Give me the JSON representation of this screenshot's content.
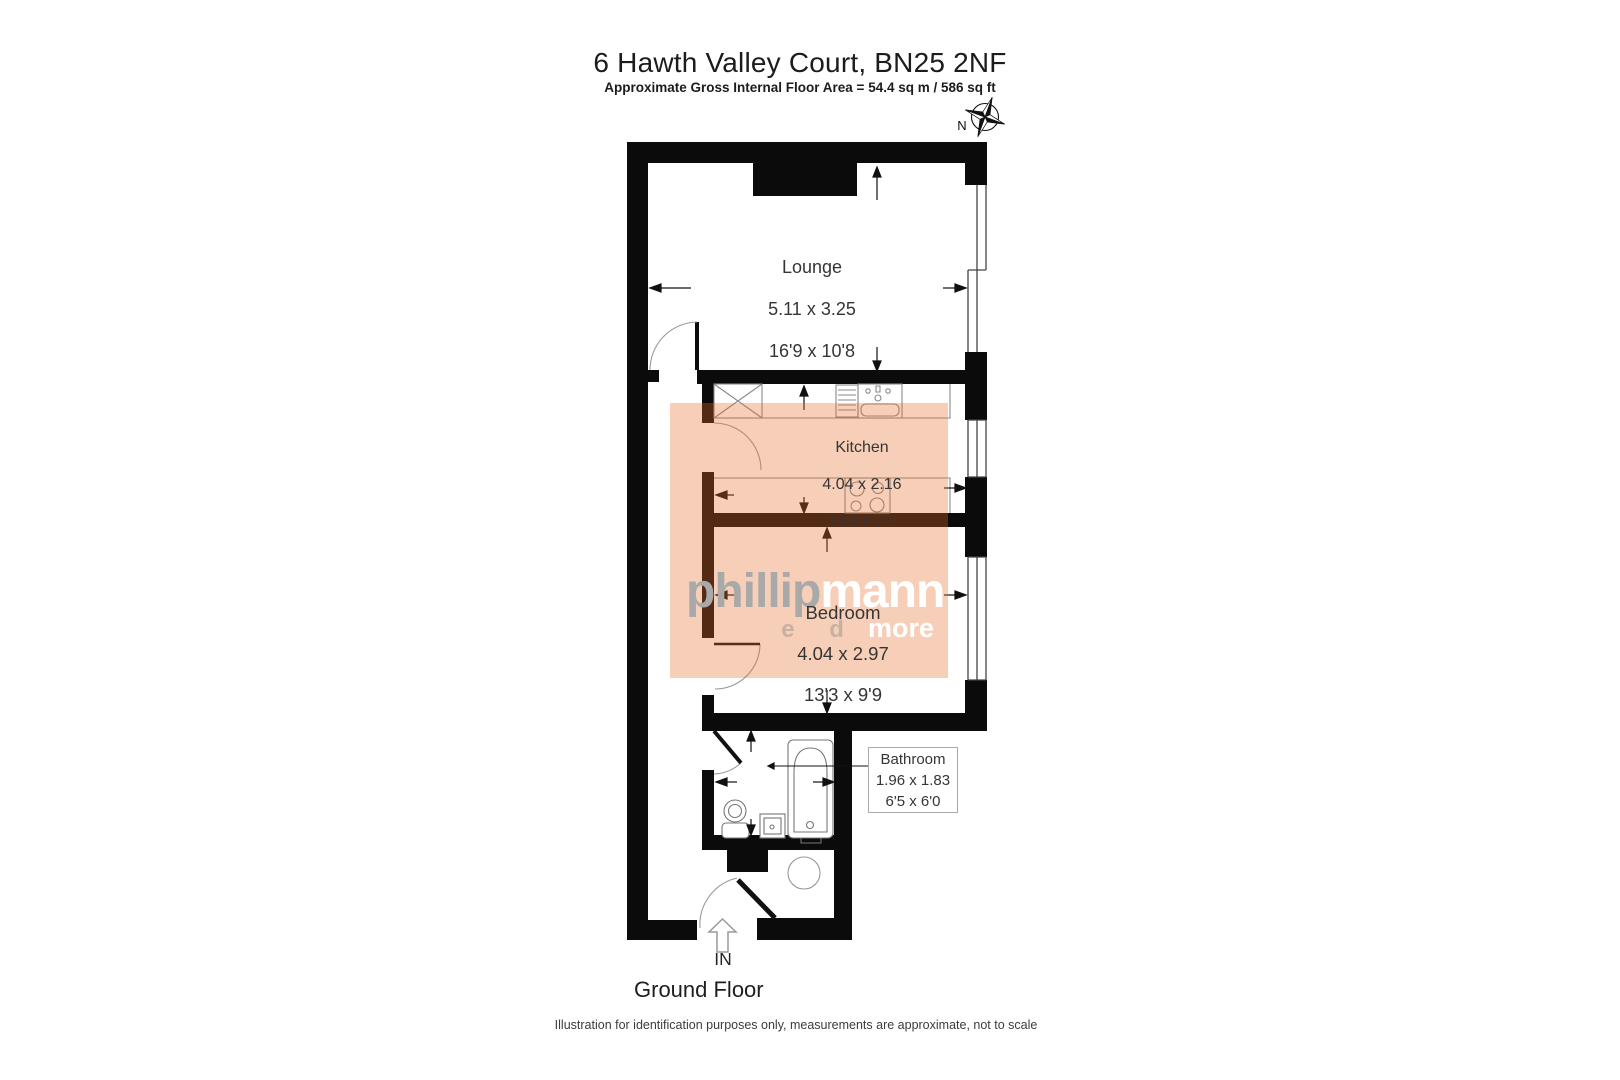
{
  "header": {
    "title": "6 Hawth Valley Court, BN25 2NF",
    "subtitle": "Approximate Gross Internal Floor Area = 54.4 sq m / 586 sq ft"
  },
  "compass": {
    "label": "N"
  },
  "rooms": {
    "lounge": {
      "name": "Lounge",
      "metric": "5.11 x 3.25",
      "imperial": "16'9 x 10'8"
    },
    "kitchen": {
      "name": "Kitchen",
      "metric": "4.04 x 2.16",
      "imperial": "13'3 x 7'1"
    },
    "bedroom": {
      "name": "Bedroom",
      "metric": "4.04 x 2.97",
      "imperial": "13'3 x 9'9"
    },
    "bathroom": {
      "name": "Bathroom",
      "metric": "1.96 x 1.83",
      "imperial": "6'5 x 6'0"
    }
  },
  "entrance": {
    "label": "IN"
  },
  "floor": {
    "label": "Ground Floor"
  },
  "footer": {
    "disclaimer": "Illustration for identification purposes only, measurements are approximate, not to scale"
  },
  "watermark": {
    "part1": "phillip",
    "part2": "mann",
    "tagline_ghost": "e d",
    "tagline": "more"
  },
  "colors": {
    "wall": "#0b0b0b",
    "room_highlight": "rgba(230,110,40,0.33)",
    "fixture_line": "#8a8a8a",
    "watermark_gray": "#a9a9a9",
    "watermark_white": "#ffffff"
  }
}
